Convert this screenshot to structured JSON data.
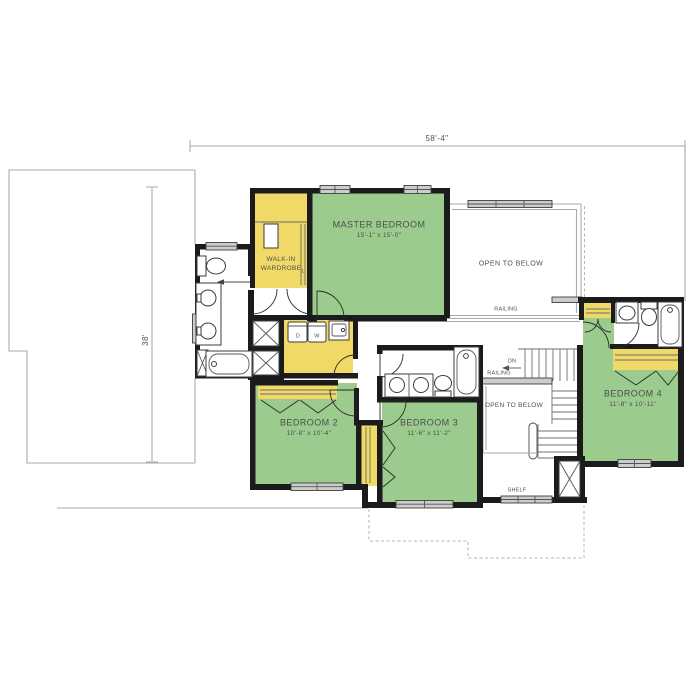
{
  "plan": {
    "dimensions": {
      "width": "58'-4\"",
      "height": "38'"
    },
    "rooms": {
      "master_bedroom": {
        "name": "MASTER BEDROOM",
        "size": "15'-1\" x 15'-0\""
      },
      "walk_in_wardrobe": {
        "line1": "WALK-IN",
        "line2": "WARDROBE"
      },
      "bedroom_2": {
        "name": "BEDROOM 2",
        "size": "10'-8\" x 10'-4\""
      },
      "bedroom_3": {
        "name": "BEDROOM 3",
        "size": "11'-6\" x 11'-2\""
      },
      "bedroom_4": {
        "name": "BEDROOM 4",
        "size": "11'-8\" x 10'-11\""
      }
    },
    "annotations": {
      "open_to_below_upper": "OPEN TO BELOW",
      "open_to_below_stairs": "OPEN TO BELOW",
      "railing_upper": "RAILING",
      "railing_stairs": "RAILING",
      "down": "DN",
      "shelf": "SHELF",
      "dryer": "D",
      "washer": "W",
      "linen": "L"
    },
    "colors": {
      "bedroom_green": "#9bcb8d",
      "closet_yellow": "#f1d967",
      "wall": "#1b1b1b",
      "outline_gray": "#ababab",
      "window_fill": "#cccccc",
      "label_text": "#4e4e4e"
    }
  }
}
